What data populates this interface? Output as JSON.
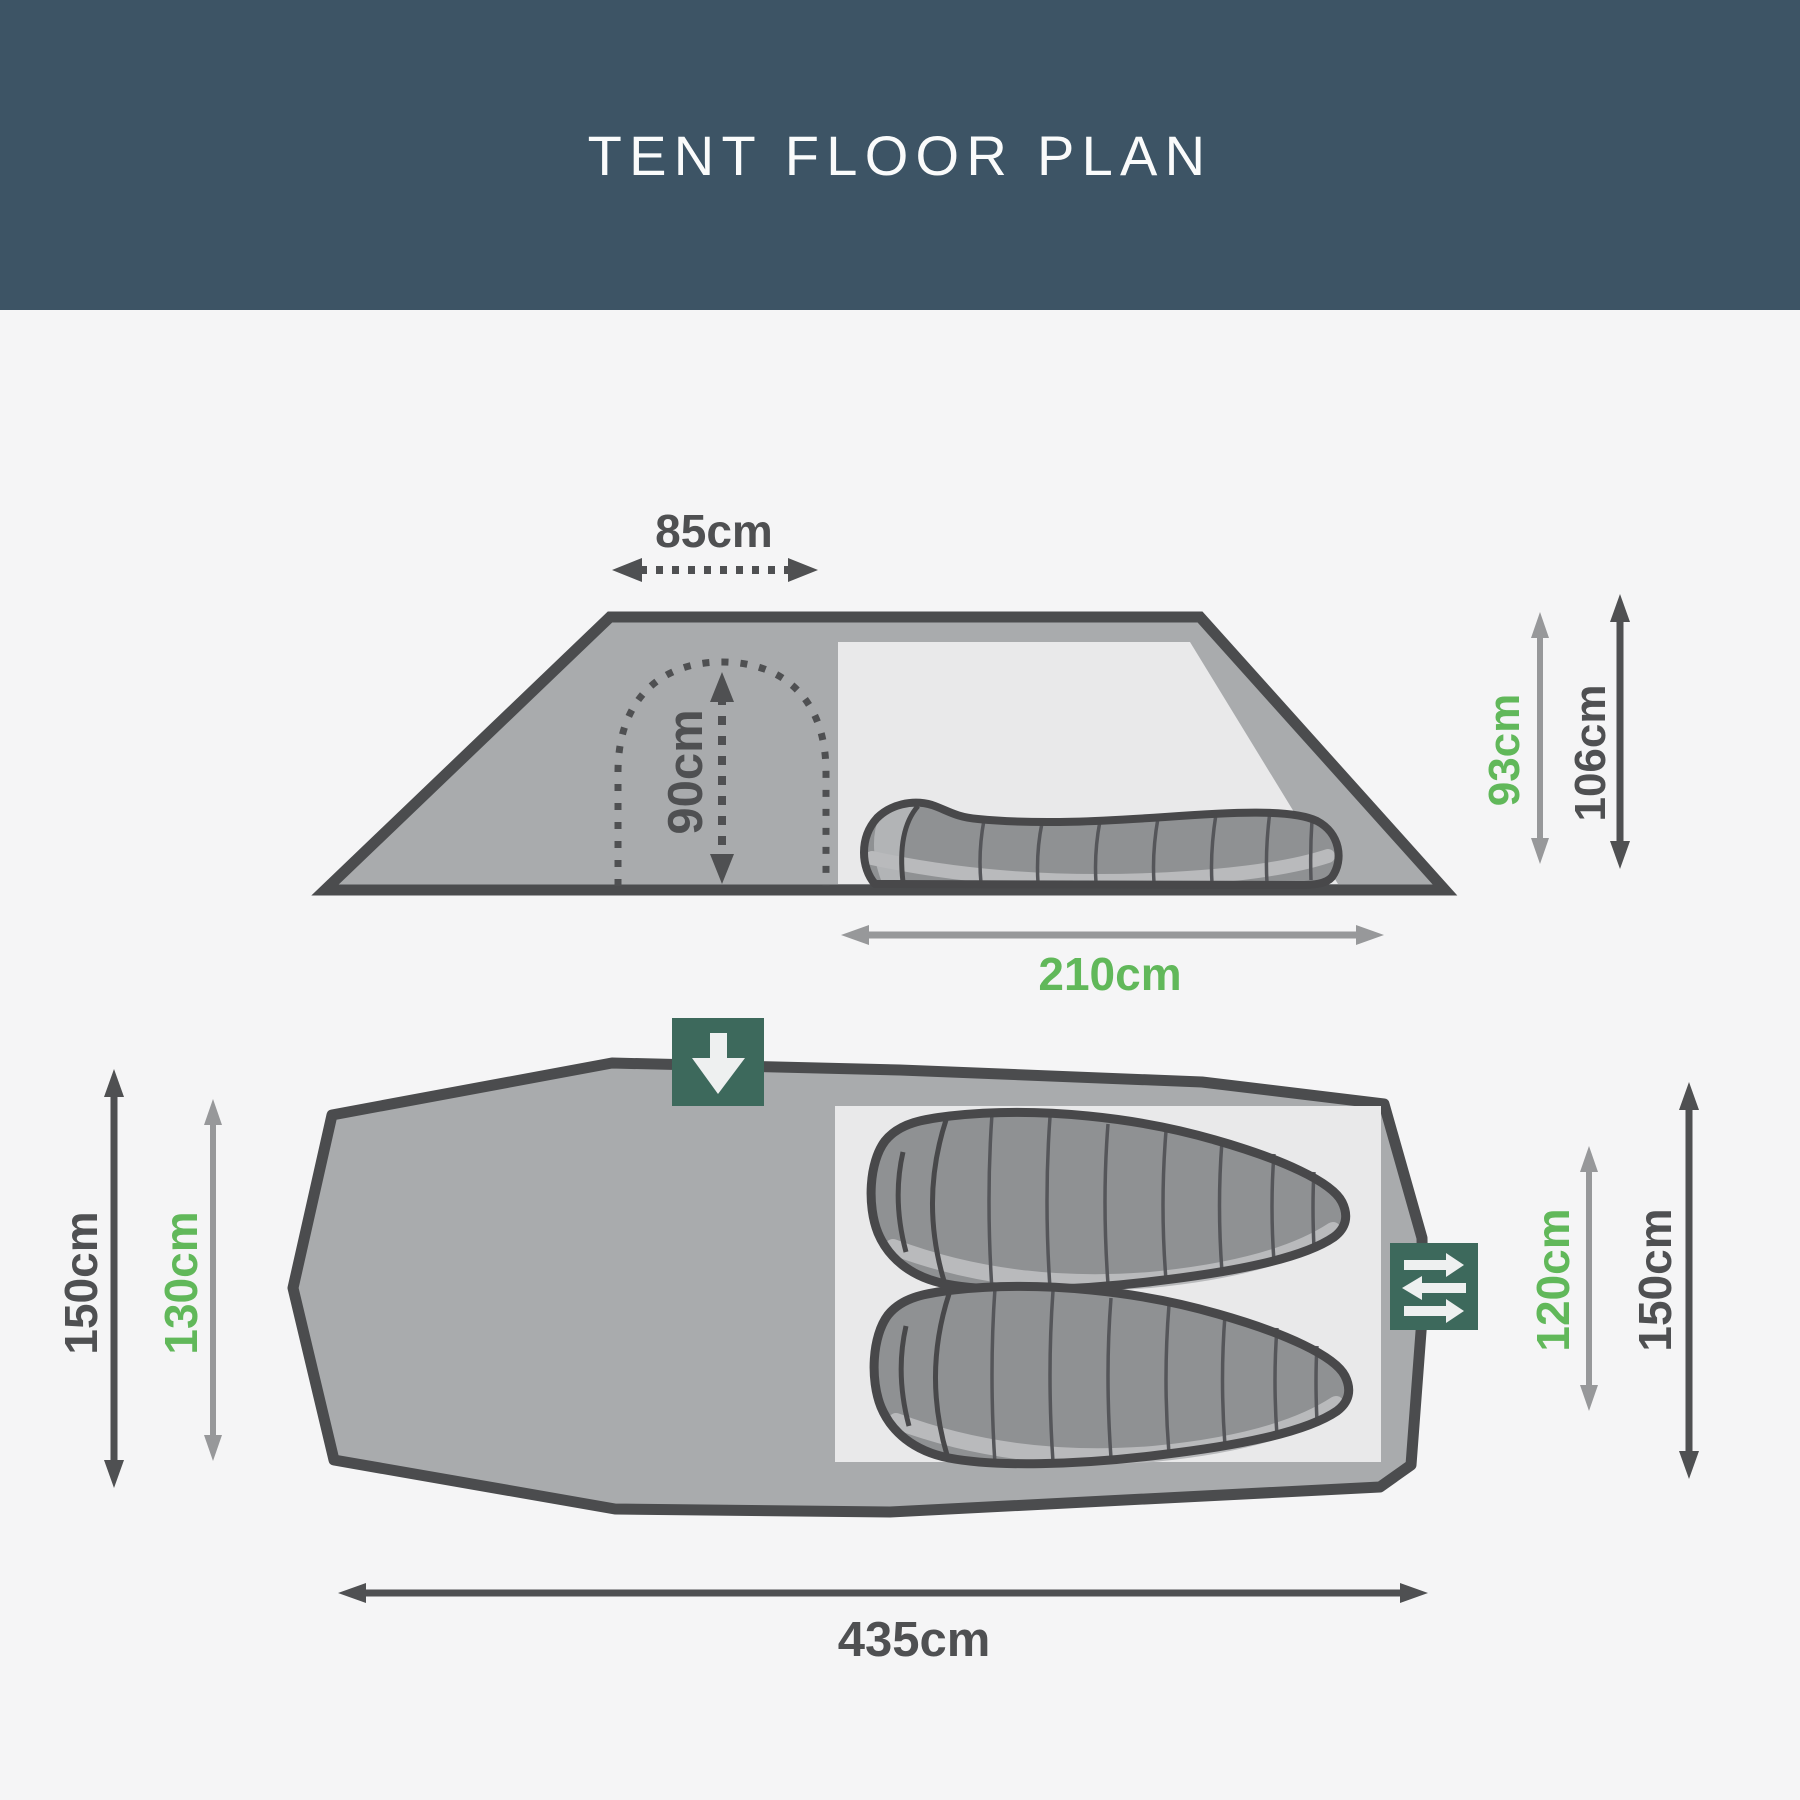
{
  "header": {
    "title": "TENT FLOOR PLAN"
  },
  "side_view": {
    "top_width_label": "85cm",
    "door_height_label": "90cm",
    "inner_height_label": "93cm",
    "outer_height_label": "106cm",
    "inner_length_label": "210cm"
  },
  "top_view": {
    "outer_width_label": "150cm",
    "inner_width_label": "130cm",
    "door_width_label": "120cm",
    "right_outer_width_label": "150cm",
    "outer_length_label": "435cm"
  },
  "icons": {
    "front_door": "arrow-down-door-icon",
    "side_door": "transfer-arrows-door-icon"
  },
  "colors": {
    "page_background": "#f5f5f6",
    "header_background": "#3d5465",
    "title_text": "#fafbfb",
    "tent_fill": "#a9abad",
    "tent_outline": "#4b4c4e",
    "inner_tent_fill": "#e9e9ea",
    "sleeping_bag_fill": "#8f9193",
    "sleeping_bag_highlight": "#b9babc",
    "sleeping_bag_outline": "#48484a",
    "seam_line": "#55565a",
    "dimension_dark": "#4f5052",
    "dimension_gray": "#97989a",
    "dimension_green": "#61b85a",
    "door_icon_green": "#3d695c",
    "icon_arrow_white": "#eef0f0"
  }
}
